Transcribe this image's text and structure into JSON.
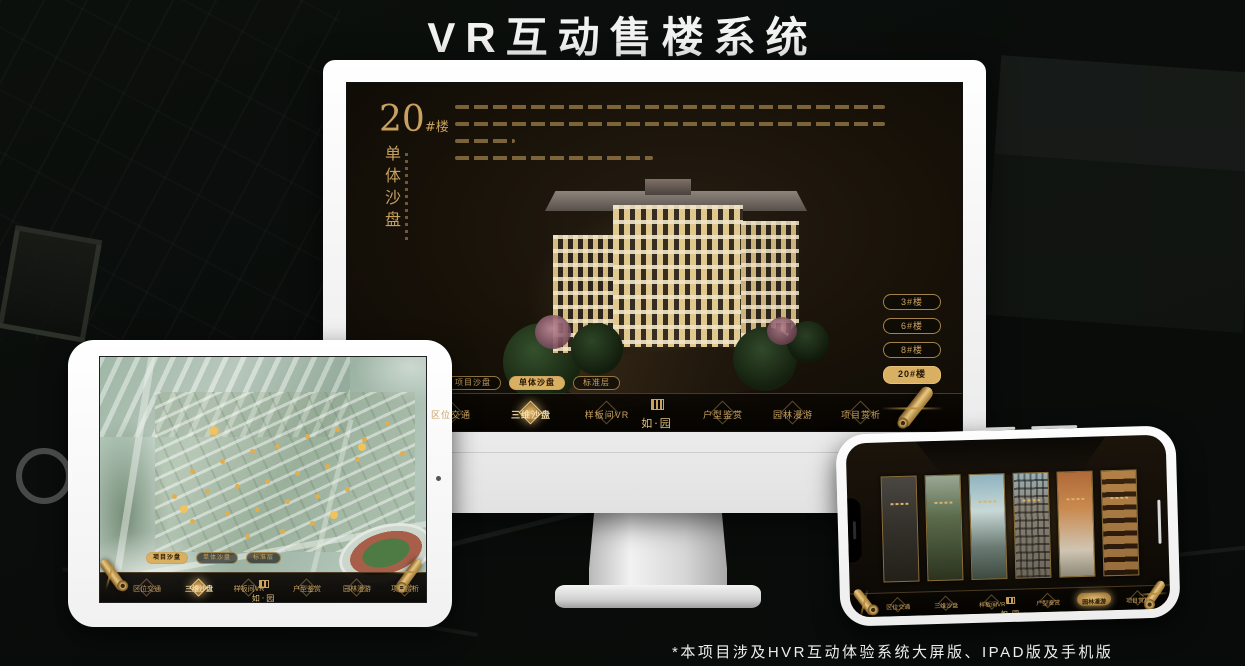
{
  "page": {
    "title": "VR互动售楼系统",
    "footnote": "*本项目涉及HVR互动体验系统大屏版、IPAD版及手机版"
  },
  "brand": {
    "logo_text": "如·园",
    "accent_gold": "#C9A15E",
    "active_gold": "#D9AF62",
    "screen_dark": "#171108"
  },
  "monitor": {
    "headline": {
      "number": "20",
      "suffix": "#楼",
      "subtitle": "单体沙盘"
    },
    "building_buttons": [
      {
        "label": "3#楼",
        "active": false
      },
      {
        "label": "6#楼",
        "active": false
      },
      {
        "label": "8#楼",
        "active": false
      },
      {
        "label": "20#楼",
        "active": true
      }
    ],
    "mode_tabs": [
      {
        "label": "项目沙盘",
        "active": false
      },
      {
        "label": "单体沙盘",
        "active": true
      },
      {
        "label": "标准层",
        "active": false
      }
    ],
    "nav_items": [
      {
        "label": "区位交通",
        "active": false
      },
      {
        "label": "三维沙盘",
        "active": true
      },
      {
        "label": "样板间VR",
        "active": false
      },
      {
        "label": "户型鉴赏",
        "active": false
      },
      {
        "label": "园林漫游",
        "active": false
      },
      {
        "label": "项目赏析",
        "active": false
      }
    ]
  },
  "tablet": {
    "mode_tabs": [
      {
        "label": "项目沙盘",
        "active": true
      },
      {
        "label": "单体沙盘",
        "active": false
      },
      {
        "label": "标准层",
        "active": false
      }
    ],
    "nav_items": [
      {
        "label": "区位交通",
        "active": false
      },
      {
        "label": "三维沙盘",
        "active": true
      },
      {
        "label": "样板间VR",
        "active": false
      },
      {
        "label": "户型鉴赏",
        "active": false
      },
      {
        "label": "园林漫游",
        "active": false
      },
      {
        "label": "项目赏析",
        "active": false
      }
    ]
  },
  "phone": {
    "nav_items": [
      {
        "label": "区位交通",
        "active": false
      },
      {
        "label": "三维沙盘",
        "active": false
      },
      {
        "label": "样板间VR",
        "active": false
      },
      {
        "label": "户型鉴赏",
        "active": false
      },
      {
        "label": "园林漫游",
        "active": true
      },
      {
        "label": "项目赏析",
        "active": false
      }
    ]
  }
}
